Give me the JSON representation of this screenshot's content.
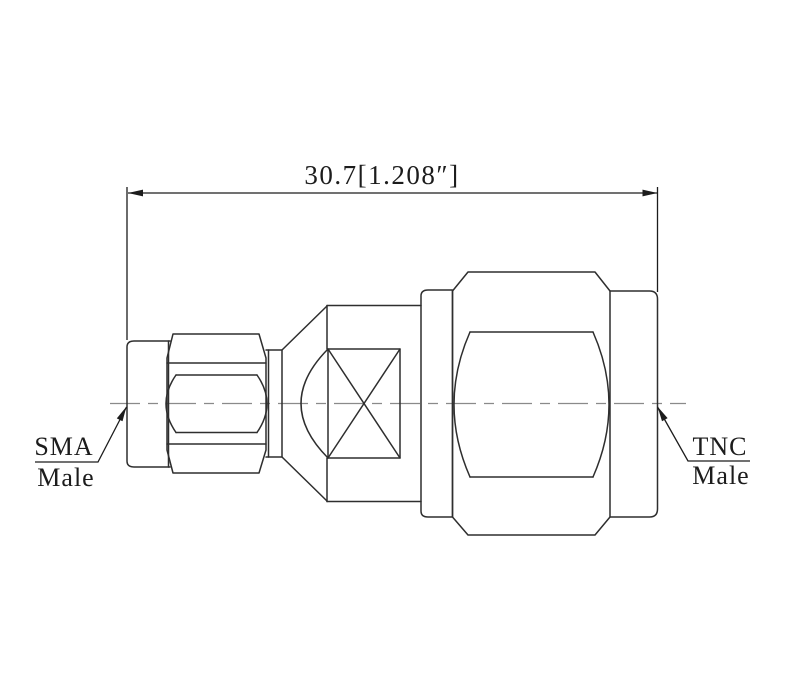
{
  "diagram": {
    "dimension_label": "30.7[1.208″]",
    "labels": {
      "left": {
        "line1": "SMA",
        "line2": "Male"
      },
      "right": {
        "line1": "TNC",
        "line2": "Male"
      }
    },
    "colors": {
      "outline": "#2e2e2e",
      "dimension": "#1c1c1c",
      "centerline": "#8a8a8a",
      "background": "#ffffff"
    }
  }
}
